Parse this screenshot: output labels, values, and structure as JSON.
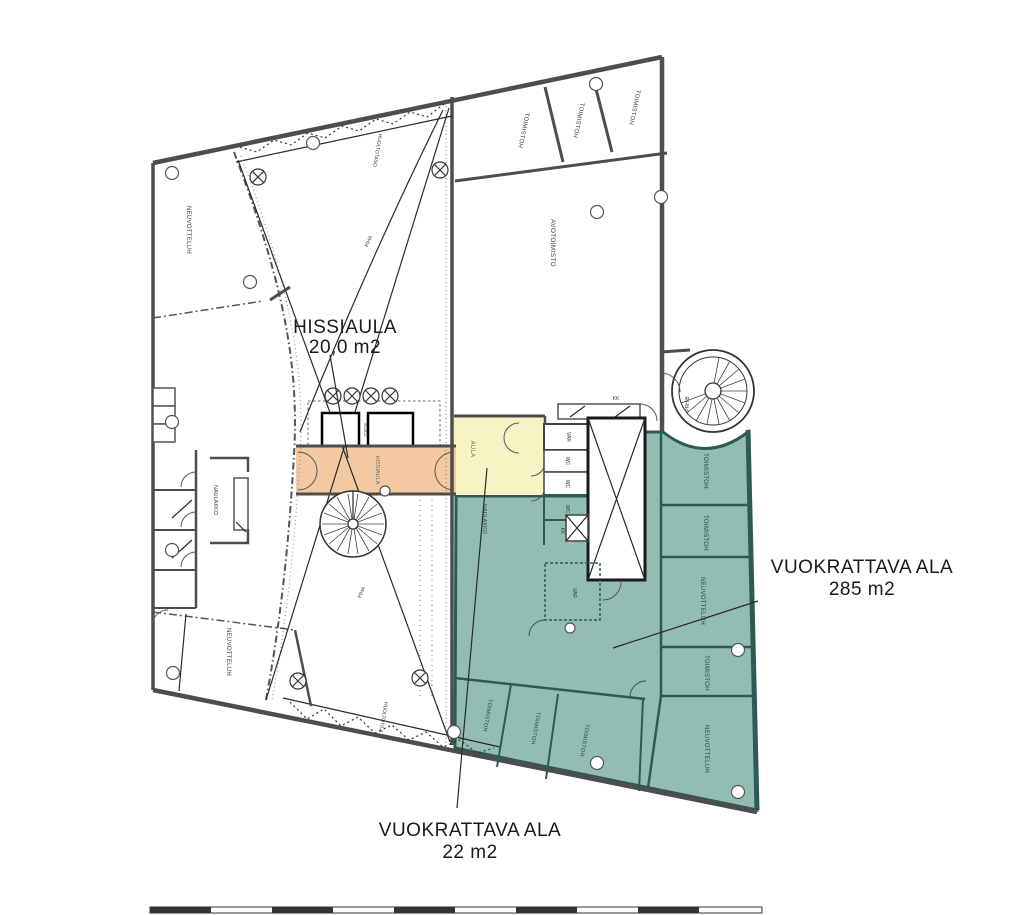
{
  "plan": {
    "annotations": {
      "hissiaula_title": "HISSIAULA",
      "hissiaula_area": "20,0  m2",
      "rentable_large_title": "VUOKRATTAVA ALA",
      "rentable_large_area": "285 m2",
      "rentable_small_title": "VUOKRATTAVA ALA",
      "rentable_small_area": "22 m2"
    },
    "rooms": {
      "top_band": [
        "TOIMISTOH",
        "TOIMISTOH",
        "TOIMISTOH"
      ],
      "open_office": "AVOTOIMISTO",
      "meeting_top_left": "NEUVOTTELUH",
      "coatrack_left": "NAULAKKO",
      "meeting_bottom_left": "NEUVOTTELUH",
      "service_top": "HUOLTOTASO",
      "service_bottom": "HUOLTOTILA",
      "yard1": "PIHA",
      "yard2": "PIHA",
      "elevator_lobby": "HISSIAULA",
      "shaft": "KUILU",
      "lobby": "AULA",
      "coatrack_teal": "NAULAKKO",
      "storage1": "VAR",
      "wc1": "WC",
      "wc2": "WC",
      "wc3": "WC",
      "kitchenette_top": "KK",
      "kitchenette_small": "KK",
      "storage2": "VAR",
      "spiral_stair": "PRH B",
      "right_column": [
        "TOIMISTOH",
        "TOIMISTOH",
        "NEUVOTTELUH",
        "TOIMISTOH",
        "NEUVOTTELUH"
      ],
      "bottom_band": [
        "TOIMISTOH",
        "TOIMISTOH",
        "TOIMISTOH"
      ]
    },
    "colors": {
      "corridor_fill": "#f2c9a1",
      "lobby_fill": "#f8f3c5",
      "rentable_fill": "#93bcb3",
      "rentable_wall": "#2d5a52",
      "wall": "#4d4d4d"
    }
  }
}
